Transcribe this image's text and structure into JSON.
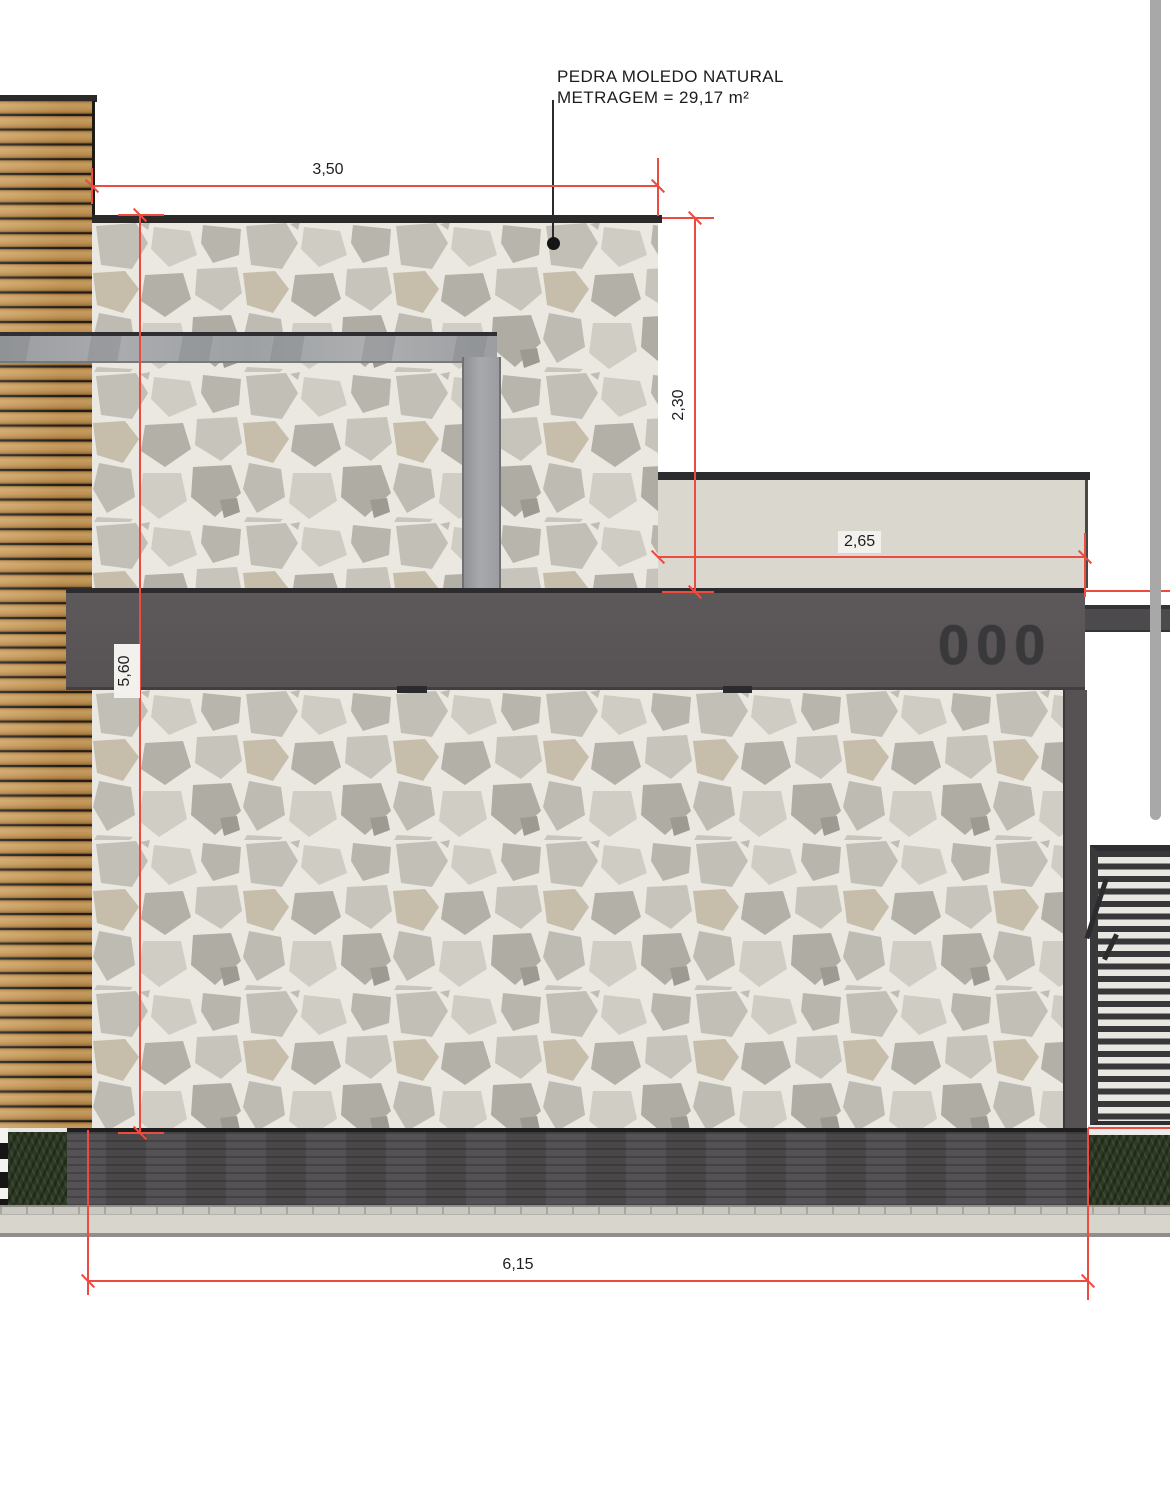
{
  "drawing": {
    "material_annotation": {
      "line1": "PEDRA MOLEDO NATURAL",
      "line2": "METRAGEM = 29,17 m²"
    },
    "house_number": "000",
    "dimensions": {
      "top_width": "3,50",
      "upper_right_height": "2,30",
      "parapet_width": "2,65",
      "left_total_height": "5,60",
      "bottom_width": "6,15"
    },
    "colors": {
      "dimension_red": "#ee4b40",
      "fascia_gray": "#595456",
      "concrete_gray": "#a0a2a5",
      "parapet_beige": "#dad7cf",
      "plinth_dark": "#4f4c4e",
      "hedge_green": "#2e3926",
      "wood_tan": "#c69a5e",
      "stone_grout": "#eae8e1",
      "scrollbar_gray": "#a8a8a8"
    }
  }
}
